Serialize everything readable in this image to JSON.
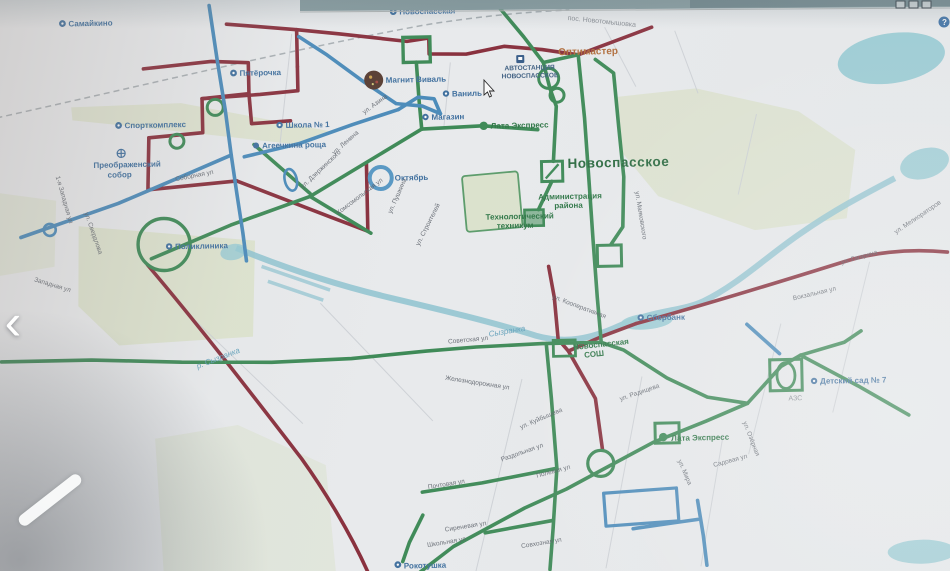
{
  "window": {
    "top_bar": {
      "minimize": "—",
      "restore": "▢",
      "close": "✕"
    },
    "help_badge": "?"
  },
  "viewer": {
    "prev_arrow": "‹"
  },
  "map": {
    "colors": {
      "route_red": "#99293a",
      "route_green": "#2f8f4e",
      "route_blue": "#3d8ec9",
      "river": "#85c8d8",
      "park": "#dde6c9",
      "poi_blue": "#3572ad",
      "poi_green": "#1f7a3d",
      "poi_orange": "#c06a2a",
      "street_text": "#565d68"
    },
    "pois": [
      {
        "text": "Самайкино"
      },
      {
        "text": "Новоспасская"
      },
      {
        "text": "пос. Новотомышовка"
      },
      {
        "text": "Оптимастер"
      },
      {
        "text": "Пятёрочка"
      },
      {
        "text": "Магнит Виваль"
      },
      {
        "text": "Ваниль"
      },
      {
        "text": "АВТОСТАНЦИЯ"
      },
      {
        "text": "НОВОСПАССКОЕ"
      },
      {
        "text": "Школа № 1"
      },
      {
        "text": "Агеечкина роща"
      },
      {
        "text": "Магазин"
      },
      {
        "text": "Лата Экспресс"
      },
      {
        "text": "Спорткомплекс"
      },
      {
        "text": "Преображенский"
      },
      {
        "text": "собор"
      },
      {
        "text": "Новоспасское"
      },
      {
        "text": "Администрация"
      },
      {
        "text": "района"
      },
      {
        "text": "Технологический"
      },
      {
        "text": "техникум"
      },
      {
        "text": "Октябрь"
      },
      {
        "text": "Поликлиника"
      },
      {
        "text": "Сбербанк"
      },
      {
        "text": "Новоспасская"
      },
      {
        "text": "СОШ"
      },
      {
        "text": "р. Сызранка"
      },
      {
        "text": "Сызранка"
      },
      {
        "text": "Детский сад № 7"
      },
      {
        "text": "АЗС"
      },
      {
        "text": "Лата Экспресс"
      },
      {
        "text": "Рокотушка"
      }
    ],
    "streets": [
      {
        "name": "1-я Западная ул"
      },
      {
        "name": "ул. Свердлова"
      },
      {
        "name": "Западная ул"
      },
      {
        "name": "ул. Азина"
      },
      {
        "name": "ул. Ленина"
      },
      {
        "name": "ул. Дзержинского"
      },
      {
        "name": "Комсомольская ул"
      },
      {
        "name": "ул. Пушкина"
      },
      {
        "name": "ул. Строителей"
      },
      {
        "name": "Соборная ул"
      },
      {
        "name": "ул. Маяковского"
      },
      {
        "name": "ул. Мелиораторов"
      },
      {
        "name": "ул. Гагарина"
      },
      {
        "name": "Вокзальная ул"
      },
      {
        "name": "Советская ул"
      },
      {
        "name": "ул. Кооперативная"
      },
      {
        "name": "Железнодорожная ул"
      },
      {
        "name": "ул. Радищева"
      },
      {
        "name": "Раздольная ул"
      },
      {
        "name": "Полевая ул"
      },
      {
        "name": "ул. Куйбышева"
      },
      {
        "name": "Почтовая ул"
      },
      {
        "name": "Сиреневая ул"
      },
      {
        "name": "Школьная ул"
      },
      {
        "name": "Совхозная ул"
      },
      {
        "name": "Садовая ул"
      },
      {
        "name": "ул. Мира"
      },
      {
        "name": "ул. Озёрная"
      }
    ]
  }
}
